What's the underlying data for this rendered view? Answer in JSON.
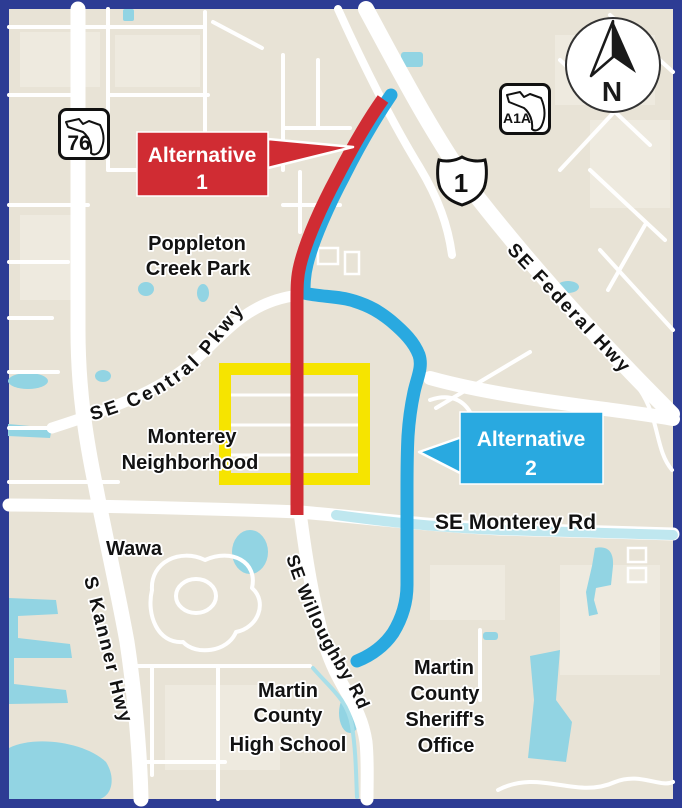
{
  "colors": {
    "frame": "#2d3c94",
    "map_bg": "#e8e3d6",
    "road": "#ffffff",
    "water": "#92d4e3",
    "alt1": "#d02c33",
    "alt2": "#29a9e0",
    "study_area": "#f6e400",
    "monterey_tint": "#bfe7ef",
    "label": "#121212"
  },
  "callouts": {
    "alt1": {
      "title": "Alternative",
      "number": "1"
    },
    "alt2": {
      "title": "Alternative",
      "number": "2"
    }
  },
  "shields": {
    "sr76": "76",
    "a1a": "A1A",
    "us1": "1"
  },
  "compass": {
    "north": "N"
  },
  "roads": {
    "central_pkwy": "SE Central Pkwy",
    "federal_hwy": "SE Federal Hwy",
    "monterey_rd": "SE Monterey Rd",
    "kanner_hwy": "S Kanner Hwy",
    "willoughby_rd": "SE Willoughby Rd"
  },
  "places": {
    "poppleton": [
      "Poppleton",
      "Creek Park"
    ],
    "monterey": [
      "Monterey",
      "Neighborhood"
    ],
    "wawa": [
      "Wawa"
    ],
    "high_school": [
      "Martin",
      "County",
      "High School"
    ],
    "sheriff": [
      "Martin",
      "County",
      "Sheriff's",
      "Office"
    ]
  }
}
